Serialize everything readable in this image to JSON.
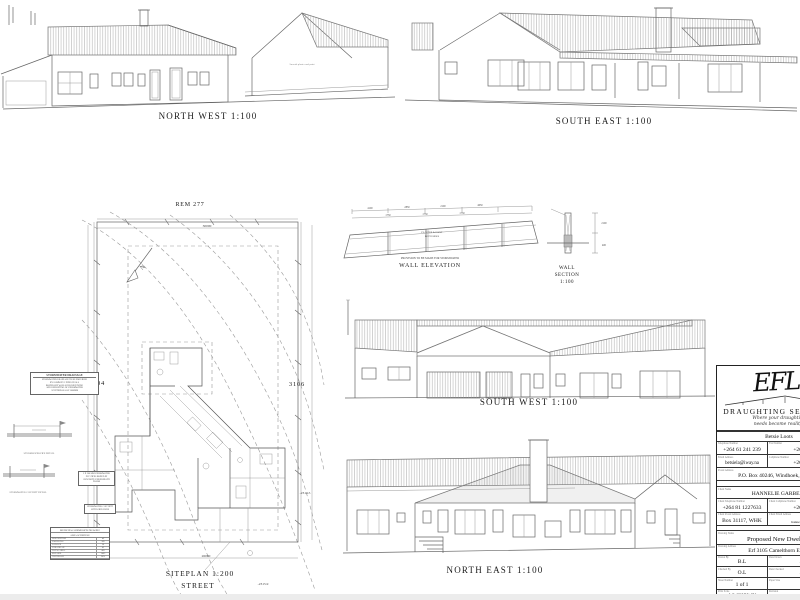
{
  "captions": {
    "north_west": "NORTH WEST 1:100",
    "south_east": "SOUTH EAST 1:100",
    "south_west": "SOUTH WEST 1:100",
    "north_east": "NORTH EAST 1:100",
    "wall_elevation": "WALL ELEVATION",
    "wall_section_line1": "WALL",
    "wall_section_line2": "SECTION",
    "wall_section_line3": "1:100",
    "siteplan": "SITEPLAN 1:200",
    "street": "STREET"
  },
  "siteplan": {
    "rem": "REM 277",
    "erf_left": "3104",
    "erf_right": "3106",
    "dim_top": "30000",
    "dim_bottom": "26000",
    "level_a": "-2314.5",
    "level_b": "-2315.9",
    "north_label": "N"
  },
  "elevation_notes": {
    "nw_wall_finish": "Smooth plaster and paint"
  },
  "wall_elevation": {
    "dims_top": [
      "4100",
      "2850",
      "2100",
      "4050"
    ],
    "dims_mid": [
      "1750",
      "1750",
      "1750"
    ],
    "panel_note_line1": "PLASTER & PAINT",
    "panel_note_line2": "BOTH SIDES",
    "bottom_note": "PROVISION TO BE MADE FOR STORMWATER"
  },
  "wall_section": {
    "dim_height": "2100",
    "dim_base": "400"
  },
  "notes": {
    "stormwater_title": "STORMWATER DRAINAGE",
    "stormwater_l1": "STORMWATER DRAINAGE TO BE PROVIDED",
    "stormwater_l2": "BY 110MM PVC PIPES IN ALL",
    "stormwater_l3": "BOUNDARY WALLS FOR RECEIVING",
    "stormwater_l4": "AND DEPOSITING OF STORMWATER",
    "stormwater_l5": "AT INTERVALS OF 2000MM",
    "pipes_note": "2 X 200 MM STORMWATER PVC PIPES BOXED IN CONCRETE UNDERNEATH FLOOR",
    "catchpit_note": "STORMWATER CATCHPIT WITH GRID OVER",
    "detail1_caption": "STORMWATER PIPE DETAIL",
    "detail2_caption": "STORMWATER CATCHPIT DETAIL"
  },
  "area_table": {
    "title": "MUNICIPAL SUBMISSION DRAWING",
    "subtitle": "AREA SCHEDULE",
    "rows": [
      [
        "DESCRIPTION",
        "m²"
      ],
      [
        "DWELLING",
        "385"
      ],
      [
        "GARAGE",
        "56"
      ],
      [
        "VERANDAH",
        "42"
      ],
      [
        "TOTAL AREA",
        "483"
      ],
      [
        "ERF SIZE",
        "1405"
      ],
      [
        "COVERAGE",
        "34%"
      ]
    ]
  },
  "title_block": {
    "logo": "EFL.",
    "company": "DRAUGHTING SERVICES",
    "tagline1": "Where your draughting",
    "tagline2": "needs become reality!",
    "contact_name": "Betsie Loots",
    "tel_label": "Telephone Number",
    "tel": "+264 61 241 239",
    "fax_label": "Fax Number",
    "fax": "+264 61 2",
    "email_label": "Email Address",
    "email": "betsiela@iway.na",
    "cell_label": "Cellphone Number",
    "cell": "+264 81 2",
    "postal_label": "Postal Address",
    "postal": "P.O. Box 40246, Windhoek, Namibia",
    "client_name_label": "Client Name",
    "client_name": "HANNELIE GARBERS",
    "client_tel_label": "Client Telephone Number",
    "client_tel": "+264 81 1227633",
    "client_cell_label": "Client Cellphone Number",
    "client_cell": "+264 81 1",
    "client_postal_label": "Client Postal Address",
    "client_postal": "Box 31117, WHK",
    "client_email_label": "Client Email Address",
    "client_email": "hannelie.garbers@",
    "drawing_name_label": "Drawing Name",
    "drawing_name": "Proposed New Dwelling",
    "drawing_address_label": "Drawing Address",
    "drawing_address": "Erf 3105 Camelthorn Estate",
    "drawn_by_label": "Drawn By",
    "drawn_by": "B.L",
    "date_drawn_label": "Date Drawn",
    "date_drawn": "30/5",
    "checked_by_label": "Checked By",
    "checked_by": "O.L",
    "date_checked_label": "Date Checked",
    "date_checked": "30/5",
    "sheet_label": "Sheet Number",
    "sheet": "1 of 1",
    "paper_label": "Paper Size",
    "paper": "A1",
    "scale_label": "Print Scale",
    "scale": "AS SHOWN",
    "rev_label": "Revision",
    "rev": "00"
  }
}
